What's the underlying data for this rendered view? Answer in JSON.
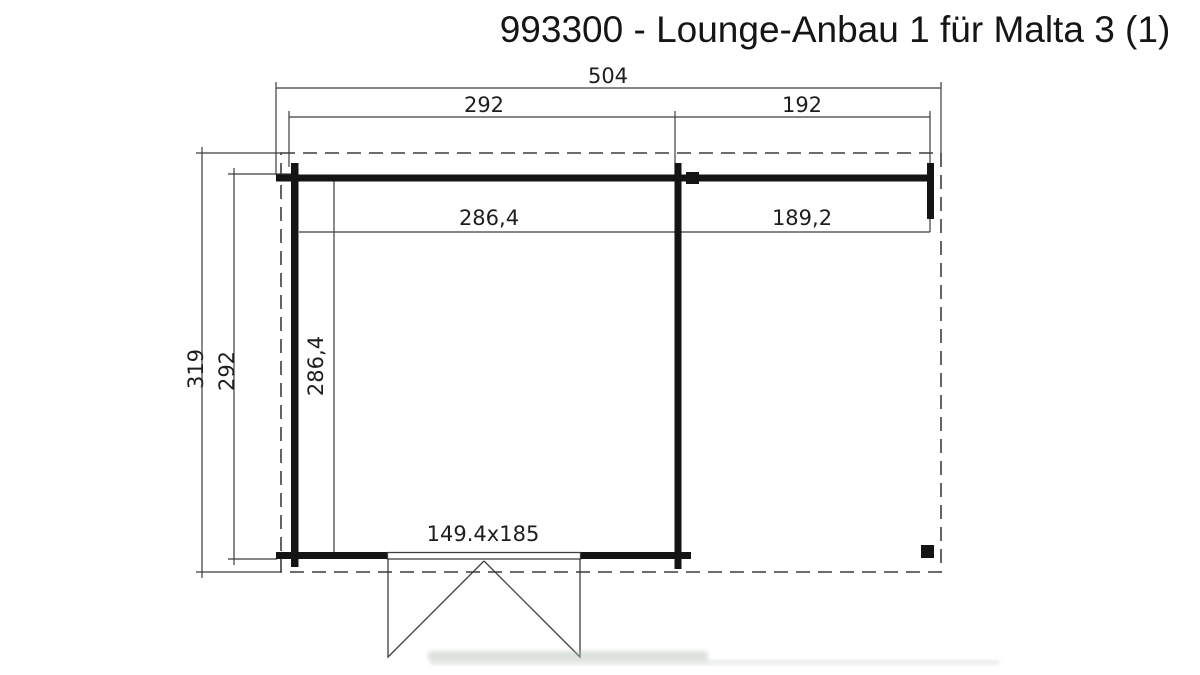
{
  "title": "993300 - Lounge-Anbau 1 für Malta 3 (1)",
  "dims": {
    "total_width": "504",
    "cabin_width": "292",
    "annex_width": "192",
    "cabin_inner_width": "286,4",
    "annex_inner_width": "189,2",
    "total_depth": "319",
    "cabin_depth": "292",
    "cabin_inner_depth": "286,4",
    "door_size": "149.4x185"
  },
  "colors": {
    "wall": "#141414",
    "thin_line": "#3d3d3d",
    "text": "#1e1e1e",
    "background": "#ffffff"
  }
}
